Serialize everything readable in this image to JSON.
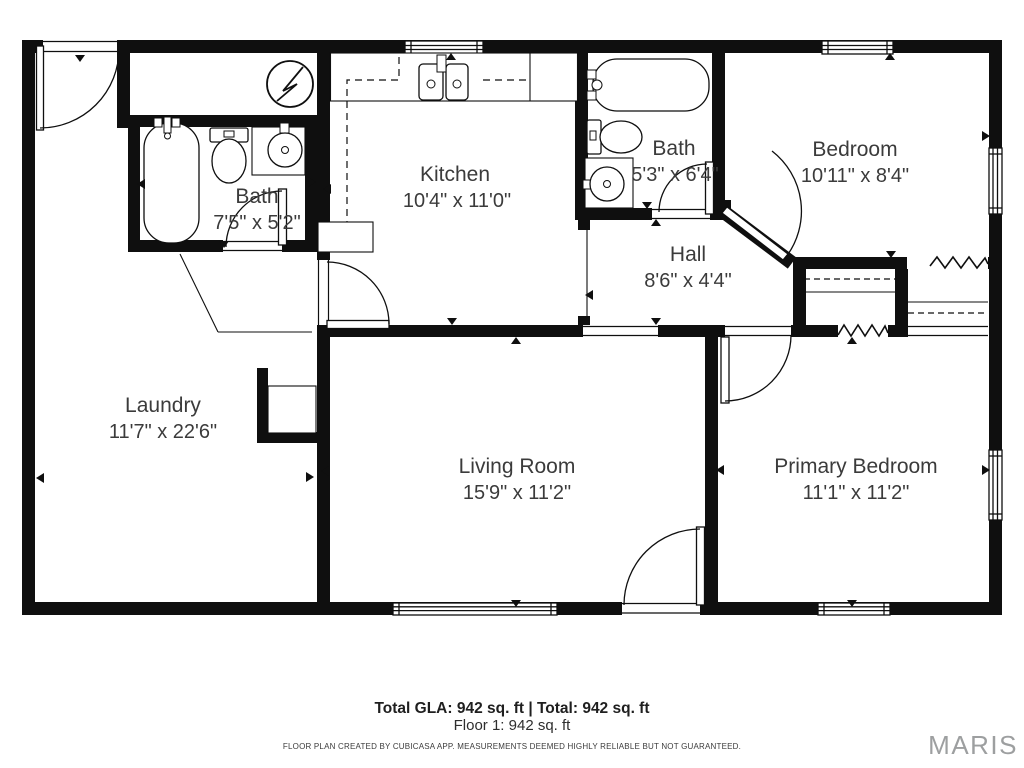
{
  "meta": {
    "app": "CubiCasa floor plan",
    "colors": {
      "walls": "#0f0f0f",
      "label_text": "#3b3b3b",
      "brand_gray": "#9d9fa0",
      "background": "#ffffff"
    }
  },
  "rooms": [
    {
      "id": "bath-1",
      "name": "Bath",
      "dims": "7'5\" x 5'2\""
    },
    {
      "id": "kitchen",
      "name": "Kitchen",
      "dims": "10'4\" x 11'0\""
    },
    {
      "id": "bath-2",
      "name": "Bath",
      "dims": "5'3\" x 6'4\""
    },
    {
      "id": "bedroom",
      "name": "Bedroom",
      "dims": "10'11\" x 8'4\""
    },
    {
      "id": "hall",
      "name": "Hall",
      "dims": "8'6\" x 4'4\""
    },
    {
      "id": "laundry",
      "name": "Laundry",
      "dims": "11'7\" x 22'6\""
    },
    {
      "id": "living-room",
      "name": "Living Room",
      "dims": "15'9\" x 11'2\""
    },
    {
      "id": "primary-bedroom",
      "name": "Primary Bedroom",
      "dims": "11'1\" x 11'2\""
    }
  ],
  "summary": {
    "total_line": "Total GLA: 942 sq. ft | Total: 942 sq. ft",
    "floor_line": "Floor 1: 942 sq. ft"
  },
  "disclaimer": "FLOOR PLAN CREATED BY CUBICASA APP. MEASUREMENTS DEEMED HIGHLY RELIABLE BUT NOT GUARANTEED.",
  "branding": {
    "logo_text": "MARIS"
  }
}
